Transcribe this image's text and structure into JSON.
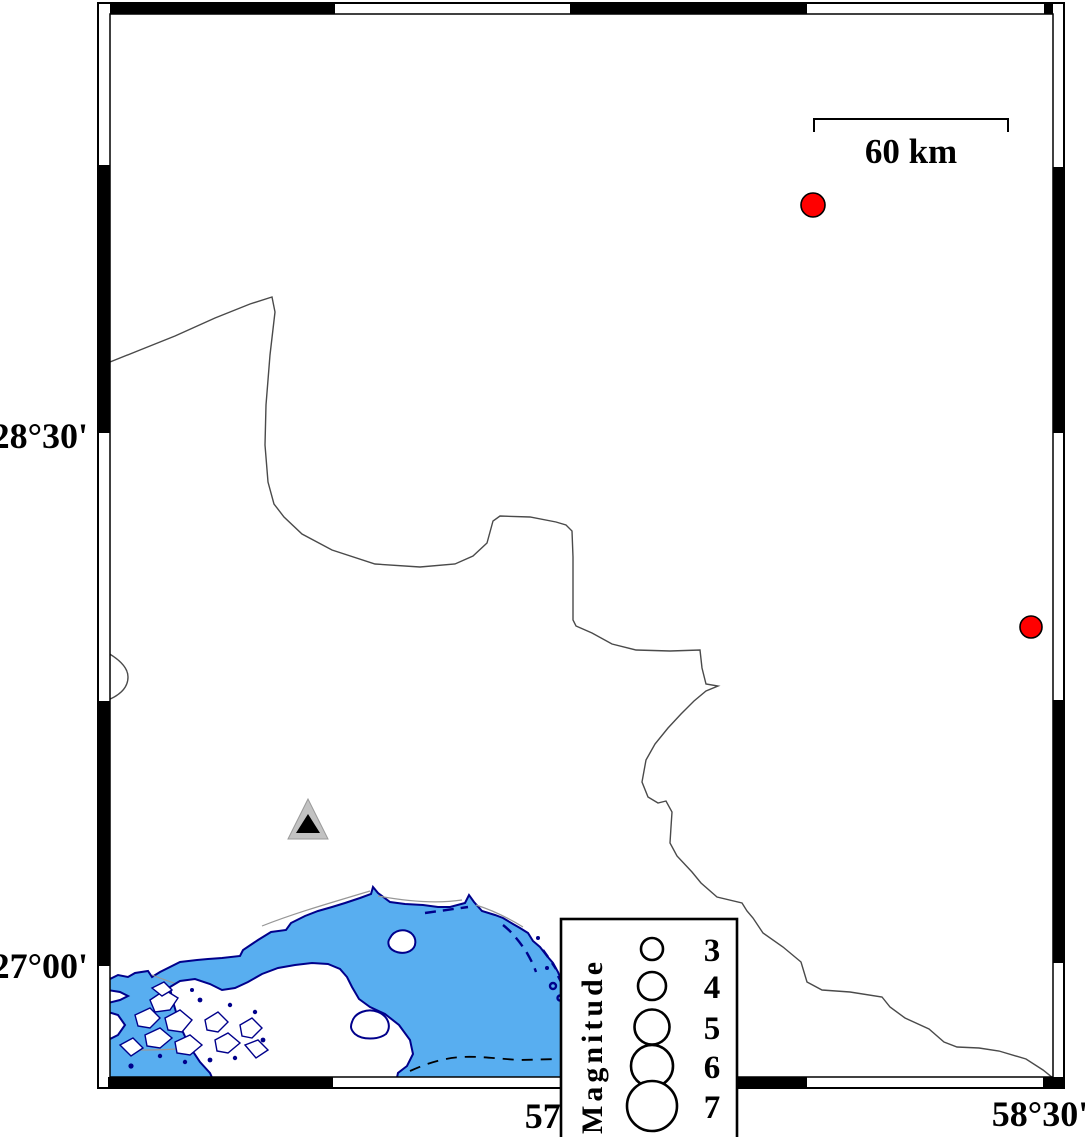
{
  "map": {
    "title": "seismicity-map",
    "lat_labels": [
      {
        "text": "28°30'",
        "y": 448
      },
      {
        "text": "27°00'",
        "y": 978
      }
    ],
    "lon_labels": [
      {
        "text": "57°00'",
        "x": 573
      },
      {
        "text": "58°30'",
        "x": 1040
      }
    ],
    "scale_bar": {
      "label": "60 km"
    },
    "legend": {
      "title": "Magnitude",
      "entries": [
        {
          "magnitude": "3",
          "radius": 11,
          "y": 949
        },
        {
          "magnitude": "4",
          "radius": 14,
          "y": 986
        },
        {
          "magnitude": "5",
          "radius": 17.5,
          "y": 1027
        },
        {
          "magnitude": "6",
          "radius": 21,
          "y": 1066
        },
        {
          "magnitude": "7",
          "radius": 25,
          "y": 1106
        }
      ]
    },
    "epicenters": [
      {
        "x": 813,
        "y": 205,
        "r": 12
      },
      {
        "x": 1031,
        "y": 627,
        "r": 11
      }
    ],
    "station": {
      "x": 308,
      "y": 839
    },
    "colors": {
      "water": "#58AEF0",
      "coastline": "#00008B",
      "epicenter": "#FF0000",
      "station_gray": "#C2C2C2",
      "station_core": "#000000",
      "frame": "#000000"
    }
  }
}
